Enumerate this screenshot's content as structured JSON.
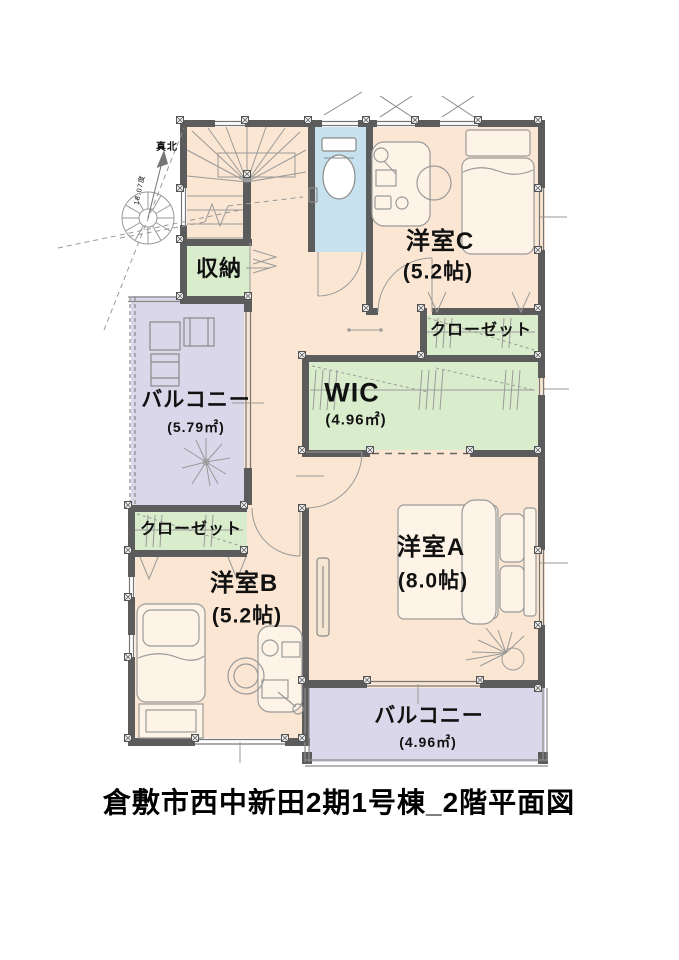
{
  "title": "倉敷市西中新田2期1号棟_2階平面図",
  "compass": {
    "north_label": "真北",
    "declination_label": "18.07度"
  },
  "rooms": {
    "storage": {
      "name": "収納"
    },
    "bedroom_c": {
      "name": "洋室C",
      "size": "(5.2帖)"
    },
    "closet_east": {
      "name": "クローゼット"
    },
    "wic": {
      "name": "WIC",
      "size": "(4.96㎡)"
    },
    "balcony_west": {
      "name": "バルコニー",
      "size": "(5.79㎡)"
    },
    "closet_west": {
      "name": "クローゼット"
    },
    "bedroom_b": {
      "name": "洋室B",
      "size": "(5.2帖)"
    },
    "bedroom_a": {
      "name": "洋室A",
      "size": "(8.0帖)"
    },
    "balcony_south": {
      "name": "バルコニー",
      "size": "(4.96㎡)"
    }
  },
  "colors": {
    "floor": "#fae6d2",
    "balcony": "#d9d7e9",
    "closet_green": "#d9eccc",
    "toilet_blue": "#c7e2ee",
    "wall": "#5c5c5c"
  }
}
